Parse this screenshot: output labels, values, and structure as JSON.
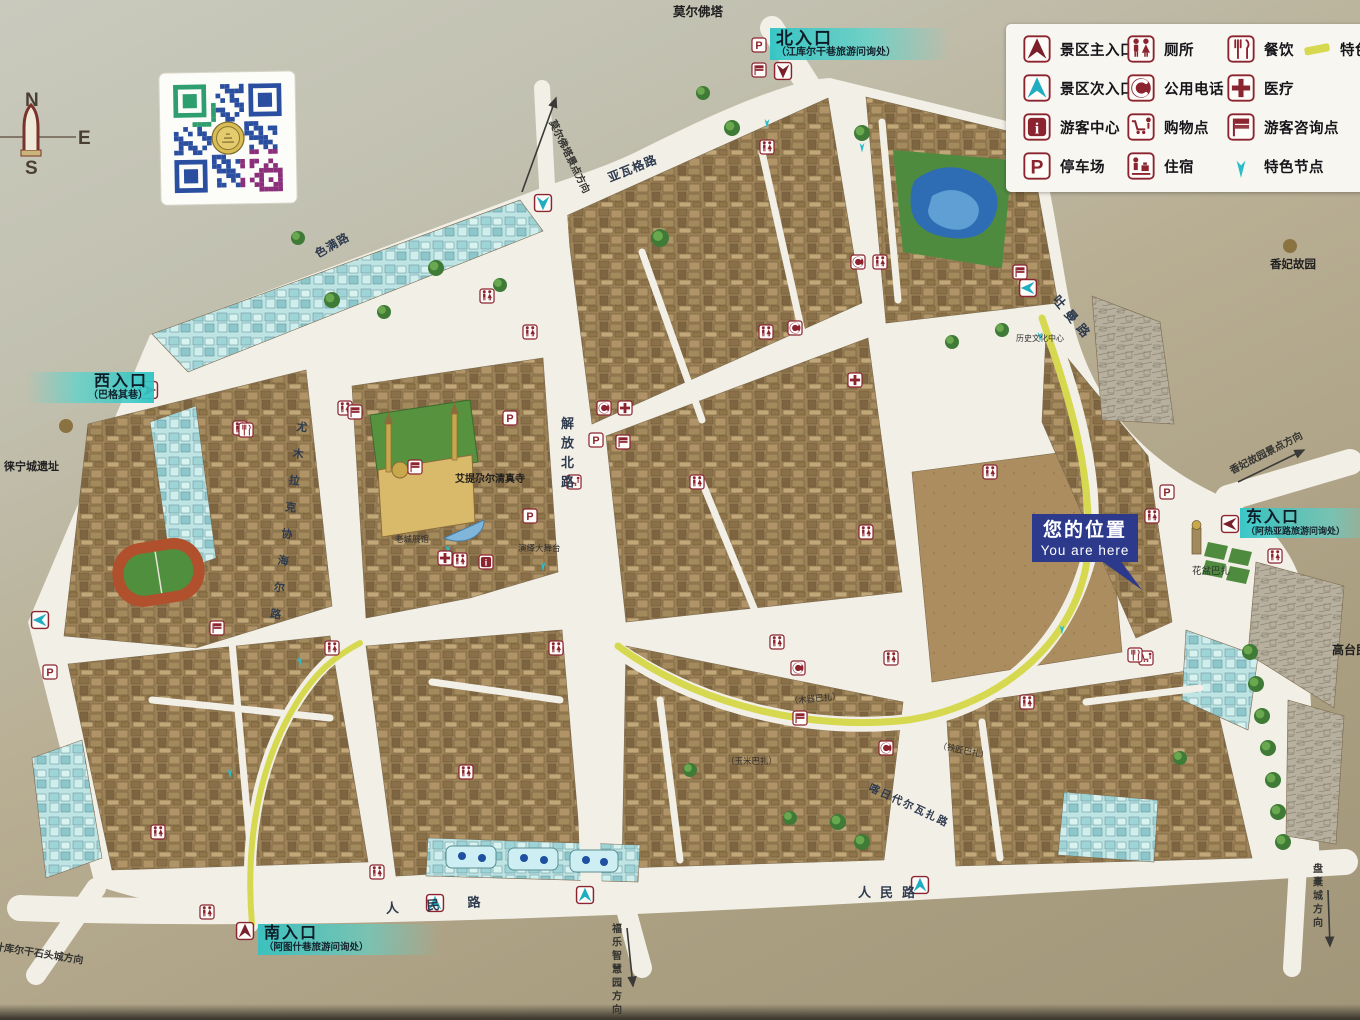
{
  "compass": {
    "n": "N",
    "e": "E",
    "s": "S"
  },
  "legend": {
    "items": [
      {
        "col": 0,
        "row": 0,
        "icon": "entrance-main",
        "label": "景区主入口"
      },
      {
        "col": 0,
        "row": 1,
        "icon": "entrance-secondary",
        "label": "景区次入口"
      },
      {
        "col": 0,
        "row": 2,
        "icon": "visitor-center",
        "label": "游客中心"
      },
      {
        "col": 0,
        "row": 3,
        "icon": "parking",
        "label": "停车场"
      },
      {
        "col": 1,
        "row": 0,
        "icon": "toilet",
        "label": "厕所"
      },
      {
        "col": 1,
        "row": 1,
        "icon": "phone",
        "label": "公用电话"
      },
      {
        "col": 1,
        "row": 2,
        "icon": "shopping",
        "label": "购物点"
      },
      {
        "col": 1,
        "row": 3,
        "icon": "lodging",
        "label": "住宿"
      },
      {
        "col": 2,
        "row": 0,
        "icon": "dining",
        "label": "餐饮"
      },
      {
        "col": 2,
        "row": 1,
        "icon": "medical",
        "label": "医疗"
      },
      {
        "col": 2,
        "row": 2,
        "icon": "info-point",
        "label": "游客咨询点"
      },
      {
        "col": 2,
        "row": 3,
        "icon": "feature-node",
        "label": "特色节点"
      },
      {
        "col": 3,
        "row": 0,
        "icon": "route",
        "label": "特色"
      }
    ]
  },
  "entrances": {
    "north": {
      "title": "北入口",
      "subtitle": "（江库尔干巷旅游问询处）"
    },
    "west": {
      "title": "西入口",
      "subtitle": "（巴格其巷）"
    },
    "east": {
      "title": "东入口",
      "subtitle": "（阿热亚路旅游问询处）"
    },
    "south": {
      "title": "南入口",
      "subtitle": "（阿图什巷旅游问询处）"
    }
  },
  "you_are_here": {
    "zh": "您的位置",
    "en": "You are here"
  },
  "colors": {
    "badge_red": "#8c2430",
    "entrance_main": "#7a1f2b",
    "teal": "#1fadc2",
    "route_yellow": "#d6d94f",
    "you_are_here_bg": "#2d3a8c",
    "road_white": "#f2efe6"
  },
  "map": {
    "labels": [
      {
        "text": "莫尔佛塔",
        "x": 673,
        "y": 16,
        "cls": "poi",
        "size": 12.5
      },
      {
        "text": "莫尔佛塔景点方向",
        "x": 549,
        "y": 122,
        "cls": "dir",
        "rot": 64
      },
      {
        "text": "亚瓦格路",
        "x": 610,
        "y": 182,
        "cls": "road",
        "rot": -22,
        "size": 12
      },
      {
        "text": "色满路",
        "x": 318,
        "y": 258,
        "cls": "road",
        "rot": -30,
        "size": 11.5
      },
      {
        "text": "香妃故园",
        "x": 1293,
        "y": 268,
        "cls": "poi",
        "size": 11.5,
        "anchor": "middle"
      },
      {
        "text": "吐曼路",
        "x": 1052,
        "y": 300,
        "cls": "road",
        "rot": 50,
        "size": 12.5,
        "spacing": 6
      },
      {
        "text": "徕宁城遗址",
        "x": 4,
        "y": 470,
        "cls": "poi",
        "size": 11
      },
      {
        "text": "解放北路",
        "x": 561,
        "y": 428,
        "cls": "road",
        "vert": true,
        "size": 13,
        "dy": 19.5
      },
      {
        "text": "尤木拉克协海尔路",
        "x": 296,
        "y": 430,
        "cls": "road",
        "vert": true,
        "size": 11,
        "dy": 27,
        "rot": 8
      },
      {
        "text": "艾提尕尔清真寺",
        "x": 455,
        "y": 482,
        "cls": "poi",
        "size": 10
      },
      {
        "text": "老城展馆",
        "x": 395,
        "y": 542,
        "cls": "small"
      },
      {
        "text": "演绎大舞台",
        "x": 518,
        "y": 551,
        "cls": "small"
      },
      {
        "text": "历史文化中心",
        "x": 1016,
        "y": 341,
        "cls": "small",
        "size": 8
      },
      {
        "text": "花盆巴扎",
        "x": 1192,
        "y": 574,
        "cls": "small",
        "size": 9.5
      },
      {
        "text": "高台民居",
        "x": 1332,
        "y": 654,
        "cls": "poi",
        "size": 12
      },
      {
        "text": "香妃故园景点方向",
        "x": 1232,
        "y": 474,
        "cls": "dir",
        "rot": -27
      },
      {
        "text": "（木器巴扎）",
        "x": 790,
        "y": 704,
        "cls": "small",
        "rot": -6
      },
      {
        "text": "（铁匠巴扎）",
        "x": 938,
        "y": 748,
        "cls": "small",
        "rot": 12
      },
      {
        "text": "（玉米巴扎）",
        "x": 726,
        "y": 764,
        "cls": "small"
      },
      {
        "text": "喀日代尔瓦扎路",
        "x": 868,
        "y": 790,
        "cls": "road",
        "rot": 25,
        "size": 10.5,
        "spacing": 2
      },
      {
        "text": "人民路",
        "x": 386,
        "y": 913,
        "cls": "road",
        "rot": -4,
        "size": 13,
        "spacing": 28
      },
      {
        "text": "人民路",
        "x": 858,
        "y": 897,
        "cls": "road",
        "size": 13,
        "spacing": 9
      },
      {
        "text": "福乐智慧园方向",
        "x": 612,
        "y": 932,
        "cls": "dir",
        "vert": true,
        "dy": 13.5
      },
      {
        "text": "盘橐城方向",
        "x": 1313,
        "y": 872,
        "cls": "dir",
        "vert": true,
        "dy": 13.5
      },
      {
        "text": "塔什库尔干石头城方向",
        "x": -16,
        "y": 948,
        "cls": "dir",
        "rot": 9
      }
    ],
    "direction_arrows": [
      {
        "x1": 522,
        "y1": 192,
        "x2": 556,
        "y2": 98
      },
      {
        "x1": 1238,
        "y1": 482,
        "x2": 1304,
        "y2": 450
      },
      {
        "x1": 627,
        "y1": 928,
        "x2": 633,
        "y2": 986
      },
      {
        "x1": 1328,
        "y1": 890,
        "x2": 1330,
        "y2": 946
      }
    ],
    "badges": [
      {
        "type": "entrance-main",
        "x": 783,
        "y": 71,
        "dir": "down"
      },
      {
        "type": "entrance-main",
        "x": 149,
        "y": 390,
        "dir": "right"
      },
      {
        "type": "entrance-main",
        "x": 1230,
        "y": 524,
        "dir": "left"
      },
      {
        "type": "entrance-main",
        "x": 245,
        "y": 931,
        "dir": "up"
      },
      {
        "type": "entrance-secondary",
        "x": 435,
        "y": 903,
        "dir": "up"
      },
      {
        "type": "entrance-secondary",
        "x": 585,
        "y": 895,
        "dir": "up"
      },
      {
        "type": "entrance-secondary",
        "x": 920,
        "y": 885,
        "dir": "up"
      },
      {
        "type": "entrance-secondary",
        "x": 40,
        "y": 620,
        "dir": "left"
      },
      {
        "type": "entrance-secondary",
        "x": 543,
        "y": 203,
        "dir": "down"
      },
      {
        "type": "entrance-secondary",
        "x": 1028,
        "y": 288,
        "dir": "left"
      },
      {
        "type": "feature-node",
        "x": 862,
        "y": 146
      },
      {
        "type": "feature-node",
        "x": 1040,
        "y": 335
      },
      {
        "type": "feature-node",
        "x": 448,
        "y": 548
      },
      {
        "type": "feature-node",
        "x": 543,
        "y": 565
      },
      {
        "type": "feature-node",
        "x": 1062,
        "y": 628
      },
      {
        "type": "feature-node",
        "x": 300,
        "y": 660
      },
      {
        "type": "feature-node",
        "x": 230,
        "y": 772
      },
      {
        "type": "feature-node",
        "x": 767,
        "y": 122
      },
      {
        "type": "parking",
        "x": 759,
        "y": 45
      },
      {
        "type": "parking",
        "x": 50,
        "y": 672
      },
      {
        "type": "parking",
        "x": 530,
        "y": 516
      },
      {
        "type": "parking",
        "x": 510,
        "y": 418
      },
      {
        "type": "parking",
        "x": 1167,
        "y": 492
      },
      {
        "type": "parking",
        "x": 596,
        "y": 440
      },
      {
        "type": "toilet",
        "x": 767,
        "y": 147
      },
      {
        "type": "toilet",
        "x": 530,
        "y": 332
      },
      {
        "type": "toilet",
        "x": 487,
        "y": 296
      },
      {
        "type": "toilet",
        "x": 345,
        "y": 408
      },
      {
        "type": "toilet",
        "x": 240,
        "y": 428
      },
      {
        "type": "toilet",
        "x": 332,
        "y": 648
      },
      {
        "type": "toilet",
        "x": 158,
        "y": 832
      },
      {
        "type": "toilet",
        "x": 207,
        "y": 912
      },
      {
        "type": "toilet",
        "x": 377,
        "y": 872
      },
      {
        "type": "toilet",
        "x": 466,
        "y": 772
      },
      {
        "type": "toilet",
        "x": 556,
        "y": 648
      },
      {
        "type": "toilet",
        "x": 697,
        "y": 482
      },
      {
        "type": "toilet",
        "x": 766,
        "y": 332
      },
      {
        "type": "toilet",
        "x": 777,
        "y": 642
      },
      {
        "type": "toilet",
        "x": 891,
        "y": 658
      },
      {
        "type": "toilet",
        "x": 866,
        "y": 532
      },
      {
        "type": "toilet",
        "x": 990,
        "y": 472
      },
      {
        "type": "toilet",
        "x": 1027,
        "y": 702
      },
      {
        "type": "toilet",
        "x": 1152,
        "y": 516
      },
      {
        "type": "toilet",
        "x": 880,
        "y": 262
      },
      {
        "type": "toilet",
        "x": 460,
        "y": 560
      },
      {
        "type": "toilet",
        "x": 1275,
        "y": 556
      },
      {
        "type": "info-point",
        "x": 759,
        "y": 70
      },
      {
        "type": "info-point",
        "x": 355,
        "y": 412
      },
      {
        "type": "info-point",
        "x": 217,
        "y": 628
      },
      {
        "type": "info-point",
        "x": 623,
        "y": 442
      },
      {
        "type": "info-point",
        "x": 800,
        "y": 718
      },
      {
        "type": "info-point",
        "x": 415,
        "y": 467
      },
      {
        "type": "info-point",
        "x": 1020,
        "y": 272
      },
      {
        "type": "phone",
        "x": 795,
        "y": 328
      },
      {
        "type": "phone",
        "x": 858,
        "y": 262
      },
      {
        "type": "phone",
        "x": 604,
        "y": 408
      },
      {
        "type": "phone",
        "x": 798,
        "y": 668
      },
      {
        "type": "phone",
        "x": 886,
        "y": 748
      },
      {
        "type": "medical",
        "x": 625,
        "y": 408
      },
      {
        "type": "medical",
        "x": 855,
        "y": 380
      },
      {
        "type": "medical",
        "x": 445,
        "y": 558
      },
      {
        "type": "visitor-center",
        "x": 486,
        "y": 562
      },
      {
        "type": "shopping",
        "x": 574,
        "y": 482
      },
      {
        "type": "shopping",
        "x": 1146,
        "y": 658
      },
      {
        "type": "dining",
        "x": 246,
        "y": 430
      },
      {
        "type": "dining",
        "x": 1135,
        "y": 655
      }
    ],
    "poi_dots": [
      {
        "x": 1290,
        "y": 246
      },
      {
        "x": 66,
        "y": 426
      }
    ]
  }
}
